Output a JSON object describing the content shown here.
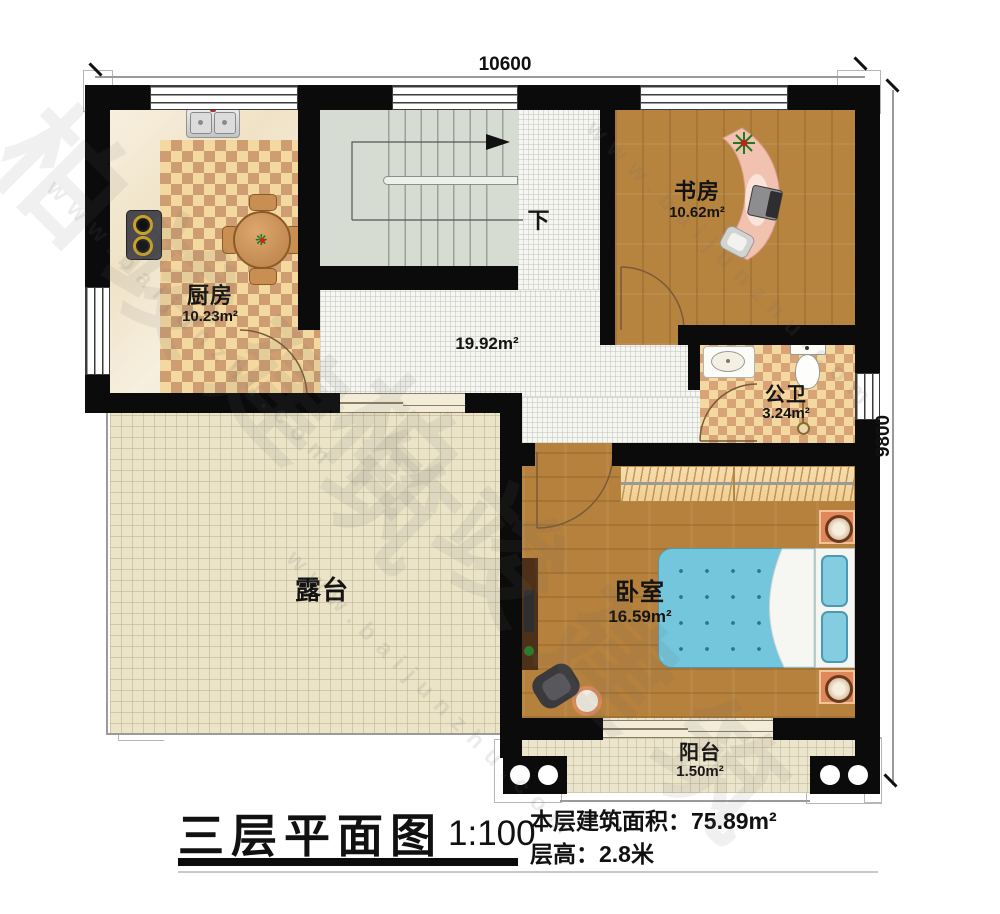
{
  "dimensions": {
    "top": "10600",
    "right": "9800"
  },
  "rooms": {
    "kitchen": {
      "name": "厨房",
      "area": "10.23m²"
    },
    "study": {
      "name": "书房",
      "area": "10.62m²"
    },
    "bathroom": {
      "name": "公卫",
      "area": "3.24m²"
    },
    "bedroom": {
      "name": "卧室",
      "area": "16.59m²"
    },
    "hallway": {
      "area": "19.92m²"
    },
    "terrace": {
      "name": "露台"
    },
    "balcony": {
      "name": "阳台",
      "area": "1.50m²"
    },
    "stairs": {
      "direction_label": "下"
    }
  },
  "titleblock": {
    "title": "三层平面图",
    "scale": "1:100",
    "floor_area_label": "本层建筑面积：",
    "floor_area_value": "75.89m²",
    "floor_height_label": "层高：",
    "floor_height_value": "2.8米"
  },
  "watermark": {
    "brand": "柏竣建筑",
    "url": "www.baijunzhu.com"
  },
  "colors": {
    "wall": "#0b0b0b",
    "wood": "#b5813c",
    "checker_light": "#f3d99f",
    "checker_dark": "#cf9d72",
    "terrace_tile": "#ebe4c9",
    "corridor_tile": "#f6f6f3",
    "stairs": "#d6dcd1",
    "bed_blue": "#74c6dc",
    "accent_orange": "#e0875c"
  }
}
